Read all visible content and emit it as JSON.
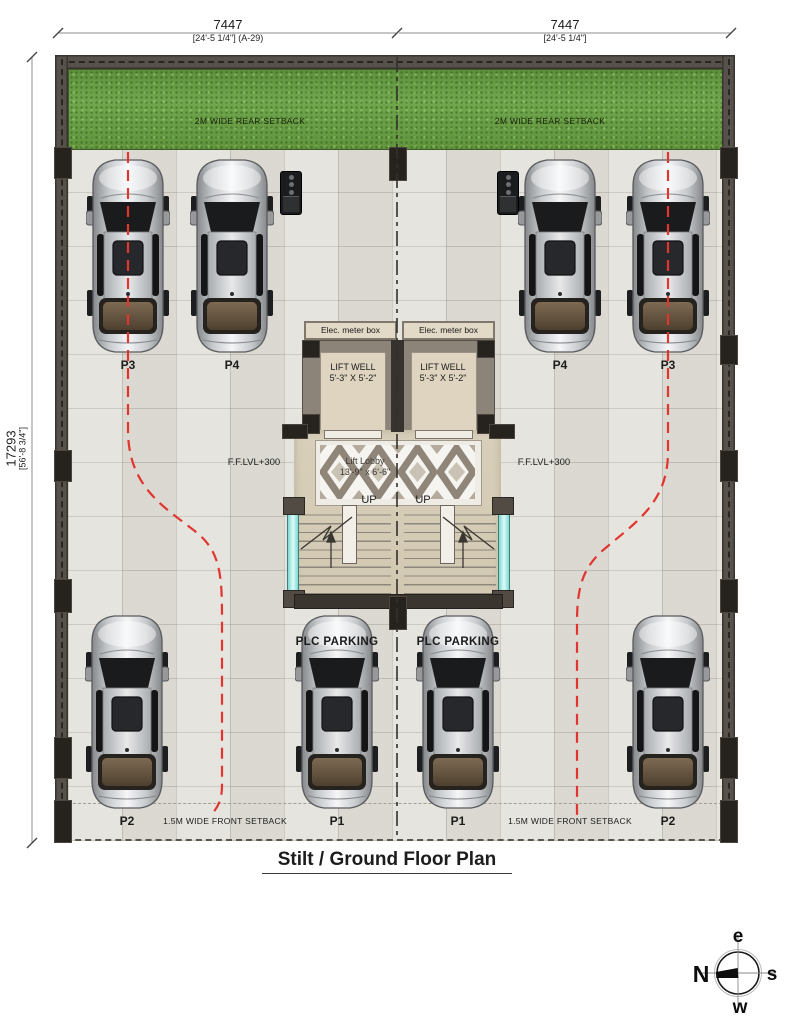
{
  "title": "Stilt / Ground Floor Plan",
  "dimensions": {
    "top_left": {
      "value": "7447",
      "sub": "[24'-5 1/4\"] (A-29)"
    },
    "top_right": {
      "value": "7447",
      "sub": "[24'-5 1/4\"]"
    },
    "left": {
      "value": "17293",
      "sub": "[56'-8 3/4\"]"
    }
  },
  "setbacks": {
    "rear_left": "2M WIDE REAR SETBACK",
    "rear_right": "2M WIDE REAR SETBACK",
    "front_left": "1.5M WIDE FRONT SETBACK",
    "front_right": "1.5M WIDE FRONT SETBACK"
  },
  "core": {
    "elec_left": "Elec. meter box",
    "elec_right": "Elec. meter box",
    "lift_well_left": {
      "line1": "LIFT WELL",
      "line2": "5'-3\" X 5'-2\""
    },
    "lift_well_right": {
      "line1": "LIFT WELL",
      "line2": "5'-3\" X 5'-2\""
    },
    "lobby": {
      "line1": "Lift Lobby",
      "line2": "13'-9\" x 6'-6\""
    },
    "ffl_left": "F.F.LVL+300",
    "ffl_right": "F.F.LVL+300",
    "up_left": "UP",
    "up_right": "UP"
  },
  "parking": {
    "slots": [
      {
        "label": "P3"
      },
      {
        "label": "P4"
      },
      {
        "label": "P4"
      },
      {
        "label": "P3"
      },
      {
        "label": "P2"
      },
      {
        "label": "P1"
      },
      {
        "label": "P1"
      },
      {
        "label": "P2"
      }
    ],
    "plc_left": "PLC PARKING",
    "plc_right": "PLC PARKING"
  },
  "compass": {
    "n": "N",
    "e": "e",
    "s": "s",
    "w": "w"
  },
  "colors": {
    "drive_path_red": "#e0362f",
    "grass_green": "#69a143",
    "wall_gray": "#57514b",
    "glass_cyan": "#aff0ec",
    "floor_tile": "#e2e0d9"
  }
}
